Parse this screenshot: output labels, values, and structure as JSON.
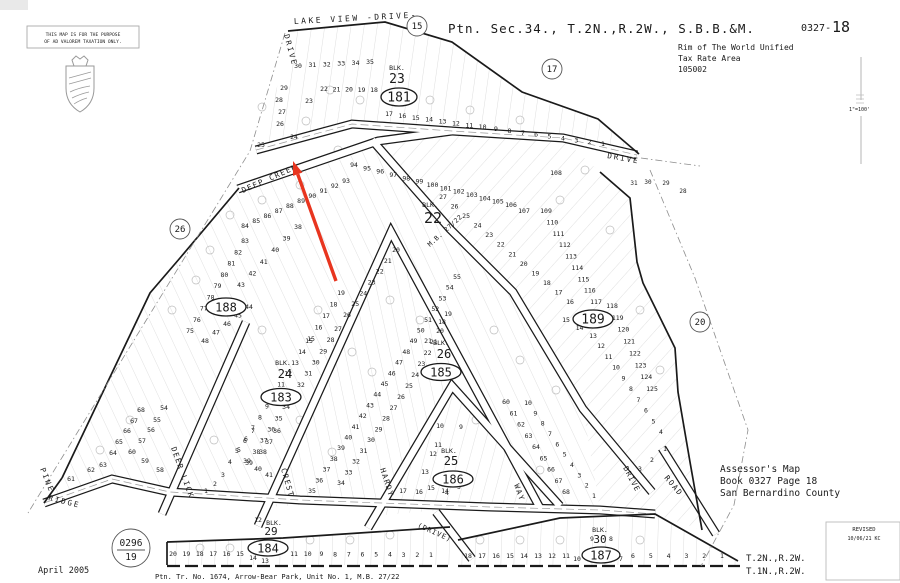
{
  "header": {
    "title": "Ptn. Sec.34., T.2N.,R.2W., S.B.B.&M.",
    "book_code": "0327-",
    "page": "18"
  },
  "tax_area": {
    "line1": "Rim of The World Unified",
    "line2": "Tax Rate Area",
    "line3": "105002"
  },
  "assessor": {
    "line1": "Assessor's Map",
    "line2": "Book 0327 Page 18",
    "line3": "San Bernardino County"
  },
  "township": {
    "line1": "T.2N.,R.2W.",
    "line2": "T.1N.,R.2W."
  },
  "disclaimer": {
    "line1": "THIS MAP IS FOR THE PURPOSE",
    "line2": "OF AD VALOREM TAXATION ONLY."
  },
  "revision": {
    "label": "REVISED",
    "entry": "10/06/21 KC"
  },
  "scale_label": "1\"=100'",
  "date_label": "April 2005",
  "tract_note": "Ptn. Tr. No. 1674, Arrow-Bear Park, Unit No. 1, M.B. 27/22",
  "annotation_arrow": {
    "color": "#e8351f",
    "x1": 336,
    "y1": 281,
    "x2": 293,
    "y2": 161
  },
  "page_refs": [
    {
      "n": "15",
      "x": 417,
      "y": 26
    },
    {
      "n": "17",
      "x": 552,
      "y": 69
    },
    {
      "n": "20",
      "x": 700,
      "y": 322
    },
    {
      "n": "26",
      "x": 180,
      "y": 229
    }
  ],
  "book_circle": {
    "top": "0296",
    "bottom": "19",
    "x": 131,
    "y": 548,
    "r": 19
  },
  "blocks": [
    {
      "label": "BLK.",
      "num": "23",
      "oval": "181",
      "lx": 397,
      "ly": 70,
      "nx": 397,
      "ny": 83,
      "ns": 13,
      "ox": 399,
      "oy": 97,
      "rx": 18,
      "ry": 9,
      "os": 13
    },
    {
      "label": "BLK.",
      "num": "22",
      "lx": 430,
      "ly": 207,
      "nx": 433,
      "ny": 223,
      "ns": 15
    },
    {
      "oval": "188",
      "ox": 226,
      "oy": 307,
      "rx": 20,
      "ry": 9,
      "os": 12
    },
    {
      "oval": "189",
      "ox": 593,
      "oy": 319,
      "rx": 20,
      "ry": 9,
      "os": 13
    },
    {
      "label": "BLK.",
      "num": "24",
      "lx": 283,
      "ly": 365,
      "nx": 285,
      "ny": 378,
      "ns": 12,
      "oval": "183",
      "ox": 281,
      "oy": 397,
      "rx": 20,
      "ry": 8.5,
      "os": 12
    },
    {
      "label": "BLK.",
      "num": "26",
      "lx": 441,
      "ly": 345,
      "nx": 444,
      "ny": 358,
      "ns": 12,
      "oval": "185",
      "ox": 441,
      "oy": 372,
      "rx": 20,
      "ry": 8.5,
      "os": 12
    },
    {
      "label": "BLK.",
      "num": "25",
      "lx": 449,
      "ly": 453,
      "nx": 451,
      "ny": 465,
      "ns": 12,
      "oval": "186",
      "ox": 453,
      "oy": 479,
      "rx": 20,
      "ry": 8,
      "os": 12
    },
    {
      "label": "BLK.",
      "num": "29",
      "lx": 274,
      "ly": 525,
      "nx": 271,
      "ny": 535,
      "ns": 11,
      "oval": "184",
      "ox": 268,
      "oy": 548,
      "rx": 20,
      "ry": 8,
      "os": 12
    },
    {
      "label": "BLK.",
      "num": "30",
      "lx": 600,
      "ly": 532,
      "nx": 600,
      "ny": 543,
      "ns": 11,
      "oval": "187",
      "ox": 601,
      "oy": 555,
      "rx": 19,
      "ry": 8,
      "os": 12
    }
  ],
  "roads": [
    {
      "t": "LAKE VIEW -DRIVE-",
      "x": 294,
      "y": 24,
      "r": -3,
      "s": 8,
      "ls": 2.5
    },
    {
      "t": "DRIVE",
      "x": 284,
      "y": 35,
      "r": 75,
      "s": 7.5,
      "ls": 2
    },
    {
      "t": "DEEP CREEK",
      "x": 243,
      "y": 193,
      "r": -24,
      "s": 7.5,
      "ls": 1.5
    },
    {
      "t": "DRIVE",
      "x": 607,
      "y": 158,
      "r": 10,
      "s": 7.5,
      "ls": 2
    },
    {
      "t": "M.B. 27/22",
      "x": 430,
      "y": 247,
      "r": -42,
      "s": 6.5,
      "ls": 0.5
    },
    {
      "t": "PINE",
      "x": 40,
      "y": 469,
      "r": 68,
      "s": 7.5,
      "ls": 2
    },
    {
      "t": "RIDGE",
      "x": 48,
      "y": 500,
      "r": 14,
      "s": 7.5,
      "ls": 2
    },
    {
      "t": "DEER LICK",
      "x": 171,
      "y": 448,
      "r": 70,
      "s": 7.5,
      "ls": 1.5
    },
    {
      "t": "CREST",
      "x": 281,
      "y": 469,
      "r": 74,
      "s": 7.5,
      "ls": 1.5
    },
    {
      "t": "HARDY",
      "x": 380,
      "y": 469,
      "r": 72,
      "s": 7.5,
      "ls": 1.5
    },
    {
      "t": "WAY",
      "x": 514,
      "y": 485,
      "r": 70,
      "s": 7.5,
      "ls": 1.5
    },
    {
      "t": "DRIVE",
      "x": 623,
      "y": 468,
      "r": 62,
      "s": 7.5,
      "ls": 1
    },
    {
      "t": "ROAD",
      "x": 664,
      "y": 478,
      "r": 50,
      "s": 7.5,
      "ls": 1.5
    },
    {
      "t": "(DRIVE)",
      "x": 417,
      "y": 527,
      "r": 24,
      "s": 7,
      "ls": 1
    }
  ],
  "parcel_rows": [
    {
      "nums": [
        "30",
        "31",
        "32",
        "33",
        "34",
        "35"
      ],
      "x1": 298,
      "y1": 68,
      "x2": 370,
      "y2": 64
    },
    {
      "nums": [
        "22",
        "21",
        "20",
        "19",
        "18"
      ],
      "x1": 324,
      "y1": 91,
      "x2": 374,
      "y2": 92
    },
    {
      "nums": [
        "17",
        "16",
        "15",
        "14",
        "13",
        "12",
        "11",
        "10",
        "9",
        "8",
        "7",
        "6",
        "5",
        "4",
        "3",
        "2",
        "1"
      ],
      "x1": 389,
      "y1": 116,
      "x2": 603,
      "y2": 146
    },
    {
      "nums": [
        "94",
        "95",
        "96",
        "97",
        "98",
        "99",
        "100",
        "101",
        "102",
        "103",
        "104",
        "105",
        "106"
      ],
      "x1": 354,
      "y1": 167,
      "x2": 511,
      "y2": 207
    },
    {
      "nums": [
        "93",
        "92",
        "91",
        "90",
        "89",
        "88",
        "87",
        "86",
        "85",
        "84"
      ],
      "x1": 346,
      "y1": 183,
      "x2": 245,
      "y2": 228
    },
    {
      "nums": [
        "109",
        "110",
        "111",
        "112",
        "113",
        "114",
        "115",
        "116",
        "117"
      ],
      "x1": 546,
      "y1": 213,
      "x2": 596,
      "y2": 304
    },
    {
      "nums": [
        "118",
        "119",
        "120",
        "121",
        "122",
        "123",
        "124",
        "125"
      ],
      "x1": 612,
      "y1": 308,
      "x2": 652,
      "y2": 391
    },
    {
      "nums": [
        "83",
        "82",
        "81",
        "80",
        "79",
        "78",
        "77",
        "76",
        "75"
      ],
      "x1": 245,
      "y1": 243,
      "x2": 190,
      "y2": 333
    },
    {
      "nums": [
        "44",
        "45",
        "46",
        "47",
        "48"
      ],
      "x1": 249,
      "y1": 309,
      "x2": 205,
      "y2": 343
    },
    {
      "nums": [
        "38",
        "39",
        "40",
        "41",
        "42",
        "43"
      ],
      "x1": 298,
      "y1": 229,
      "x2": 241,
      "y2": 287
    },
    {
      "nums": [
        "20",
        "21",
        "22",
        "23",
        "24",
        "25",
        "26"
      ],
      "x1": 396,
      "y1": 252,
      "x2": 347,
      "y2": 317
    },
    {
      "nums": [
        "19",
        "18",
        "17",
        "16",
        "15"
      ],
      "x1": 341,
      "y1": 295,
      "x2": 311,
      "y2": 341
    },
    {
      "nums": [
        "27",
        "26",
        "25",
        "24",
        "23",
        "22",
        "21",
        "20",
        "19",
        "18",
        "17",
        "16"
      ],
      "x1": 443,
      "y1": 199,
      "x2": 570,
      "y2": 304
    },
    {
      "nums": [
        "15",
        "14",
        "13"
      ],
      "x1": 566,
      "y1": 322,
      "x2": 593,
      "y2": 338
    },
    {
      "nums": [
        "15",
        "14",
        "13",
        "12",
        "11",
        "10",
        "9",
        "8",
        "7",
        "6",
        "5"
      ],
      "x1": 309,
      "y1": 343,
      "x2": 239,
      "y2": 452
    },
    {
      "nums": [
        "27",
        "28",
        "29",
        "30",
        "31",
        "32",
        "33",
        "34",
        "35",
        "36",
        "37",
        "38",
        "39"
      ],
      "x1": 338,
      "y1": 331,
      "x2": 249,
      "y2": 465
    },
    {
      "nums": [
        "55",
        "54",
        "53",
        "52",
        "51",
        "50",
        "49",
        "48",
        "47",
        "46",
        "45",
        "44",
        "43",
        "42",
        "41",
        "40",
        "39",
        "38",
        "37",
        "36",
        "35"
      ],
      "x1": 457,
      "y1": 279,
      "x2": 312,
      "y2": 493
    },
    {
      "nums": [
        "26",
        "27",
        "28",
        "29",
        "30",
        "31",
        "32",
        "33",
        "34"
      ],
      "x1": 401,
      "y1": 399,
      "x2": 341,
      "y2": 485
    },
    {
      "nums": [
        "20",
        "21",
        "22",
        "23",
        "24",
        "25"
      ],
      "x1": 440,
      "y1": 333,
      "x2": 409,
      "y2": 388
    },
    {
      "nums": [
        "60",
        "61",
        "62",
        "63",
        "64",
        "65",
        "66",
        "67",
        "68"
      ],
      "x1": 506,
      "y1": 404,
      "x2": 566,
      "y2": 494
    },
    {
      "nums": [
        "10",
        "9",
        "8",
        "7",
        "6",
        "5",
        "4",
        "3",
        "2",
        "1"
      ],
      "x1": 528,
      "y1": 405,
      "x2": 594,
      "y2": 498
    },
    {
      "nums": [
        "12",
        "11",
        "10",
        "9",
        "8",
        "7",
        "6",
        "5",
        "4"
      ],
      "x1": 601,
      "y1": 348,
      "x2": 661,
      "y2": 434
    },
    {
      "nums": [
        "20",
        "19",
        "18",
        "17",
        "16",
        "15"
      ],
      "x1": 173,
      "y1": 556,
      "x2": 240,
      "y2": 556
    },
    {
      "nums": [
        "11",
        "10",
        "9",
        "8",
        "7",
        "6",
        "5",
        "4",
        "3",
        "2",
        "1"
      ],
      "x1": 294,
      "y1": 556,
      "x2": 431,
      "y2": 557
    },
    {
      "nums": [
        "18",
        "17",
        "16",
        "15",
        "14",
        "13",
        "12",
        "11"
      ],
      "x1": 468,
      "y1": 558,
      "x2": 566,
      "y2": 558
    },
    {
      "nums": [
        "6",
        "5",
        "4",
        "3",
        "2",
        "1"
      ],
      "x1": 633,
      "y1": 558,
      "x2": 722,
      "y2": 558
    }
  ],
  "parcel_numbers": [
    {
      "t": "29",
      "x": 284,
      "y": 90
    },
    {
      "t": "28",
      "x": 279,
      "y": 102
    },
    {
      "t": "23",
      "x": 309,
      "y": 103
    },
    {
      "t": "27",
      "x": 282,
      "y": 114
    },
    {
      "t": "26",
      "x": 280,
      "y": 126
    },
    {
      "t": "24",
      "x": 294,
      "y": 139
    },
    {
      "t": "25",
      "x": 261,
      "y": 147
    },
    {
      "t": "107",
      "x": 524,
      "y": 213
    },
    {
      "t": "108",
      "x": 556,
      "y": 175
    },
    {
      "t": "19",
      "x": 448,
      "y": 316
    },
    {
      "t": "18",
      "x": 442,
      "y": 324
    },
    {
      "t": "21",
      "x": 428,
      "y": 343
    },
    {
      "t": "10",
      "x": 440,
      "y": 428
    },
    {
      "t": "9",
      "x": 461,
      "y": 429
    },
    {
      "t": "11",
      "x": 438,
      "y": 447
    },
    {
      "t": "12",
      "x": 433,
      "y": 456
    },
    {
      "t": "13",
      "x": 425,
      "y": 474
    },
    {
      "t": "17",
      "x": 403,
      "y": 493
    },
    {
      "t": "16",
      "x": 419,
      "y": 494
    },
    {
      "t": "15",
      "x": 431,
      "y": 490
    },
    {
      "t": "14",
      "x": 445,
      "y": 493
    },
    {
      "t": "5",
      "x": 459,
      "y": 489
    },
    {
      "t": "4",
      "x": 447,
      "y": 495
    },
    {
      "t": "7",
      "x": 253,
      "y": 433
    },
    {
      "t": "36",
      "x": 277,
      "y": 433
    },
    {
      "t": "6",
      "x": 245,
      "y": 443
    },
    {
      "t": "37",
      "x": 269,
      "y": 444
    },
    {
      "t": "5",
      "x": 237,
      "y": 453
    },
    {
      "t": "38",
      "x": 263,
      "y": 454
    },
    {
      "t": "4",
      "x": 230,
      "y": 464
    },
    {
      "t": "39",
      "x": 247,
      "y": 463
    },
    {
      "t": "40",
      "x": 258,
      "y": 471
    },
    {
      "t": "3",
      "x": 223,
      "y": 477
    },
    {
      "t": "41",
      "x": 269,
      "y": 477
    },
    {
      "t": "2",
      "x": 215,
      "y": 486
    },
    {
      "t": "1",
      "x": 206,
      "y": 493
    },
    {
      "t": "68",
      "x": 141,
      "y": 412
    },
    {
      "t": "54",
      "x": 164,
      "y": 410
    },
    {
      "t": "67",
      "x": 134,
      "y": 423
    },
    {
      "t": "55",
      "x": 157,
      "y": 422
    },
    {
      "t": "66",
      "x": 127,
      "y": 433
    },
    {
      "t": "56",
      "x": 151,
      "y": 432
    },
    {
      "t": "65",
      "x": 119,
      "y": 444
    },
    {
      "t": "57",
      "x": 142,
      "y": 443
    },
    {
      "t": "64",
      "x": 113,
      "y": 455
    },
    {
      "t": "60",
      "x": 132,
      "y": 454
    },
    {
      "t": "63",
      "x": 103,
      "y": 467
    },
    {
      "t": "59",
      "x": 145,
      "y": 463
    },
    {
      "t": "62",
      "x": 91,
      "y": 472
    },
    {
      "t": "58",
      "x": 160,
      "y": 472
    },
    {
      "t": "61",
      "x": 71,
      "y": 481
    },
    {
      "t": "14",
      "x": 253,
      "y": 560
    },
    {
      "t": "13",
      "x": 265,
      "y": 563
    },
    {
      "t": "12",
      "x": 258,
      "y": 522
    },
    {
      "t": "10",
      "x": 577,
      "y": 561
    },
    {
      "t": "9",
      "x": 592,
      "y": 541
    },
    {
      "t": "8",
      "x": 611,
      "y": 541
    },
    {
      "t": "7",
      "x": 621,
      "y": 561
    },
    {
      "t": "3",
      "x": 640,
      "y": 471
    },
    {
      "t": "2",
      "x": 652,
      "y": 462
    },
    {
      "t": "1",
      "x": 665,
      "y": 451
    }
  ],
  "adjacent_numbers": [
    {
      "t": "31",
      "x": 634,
      "y": 185
    },
    {
      "t": "30",
      "x": 648,
      "y": 184
    },
    {
      "t": "29",
      "x": 666,
      "y": 185
    },
    {
      "t": "28",
      "x": 683,
      "y": 193
    }
  ]
}
